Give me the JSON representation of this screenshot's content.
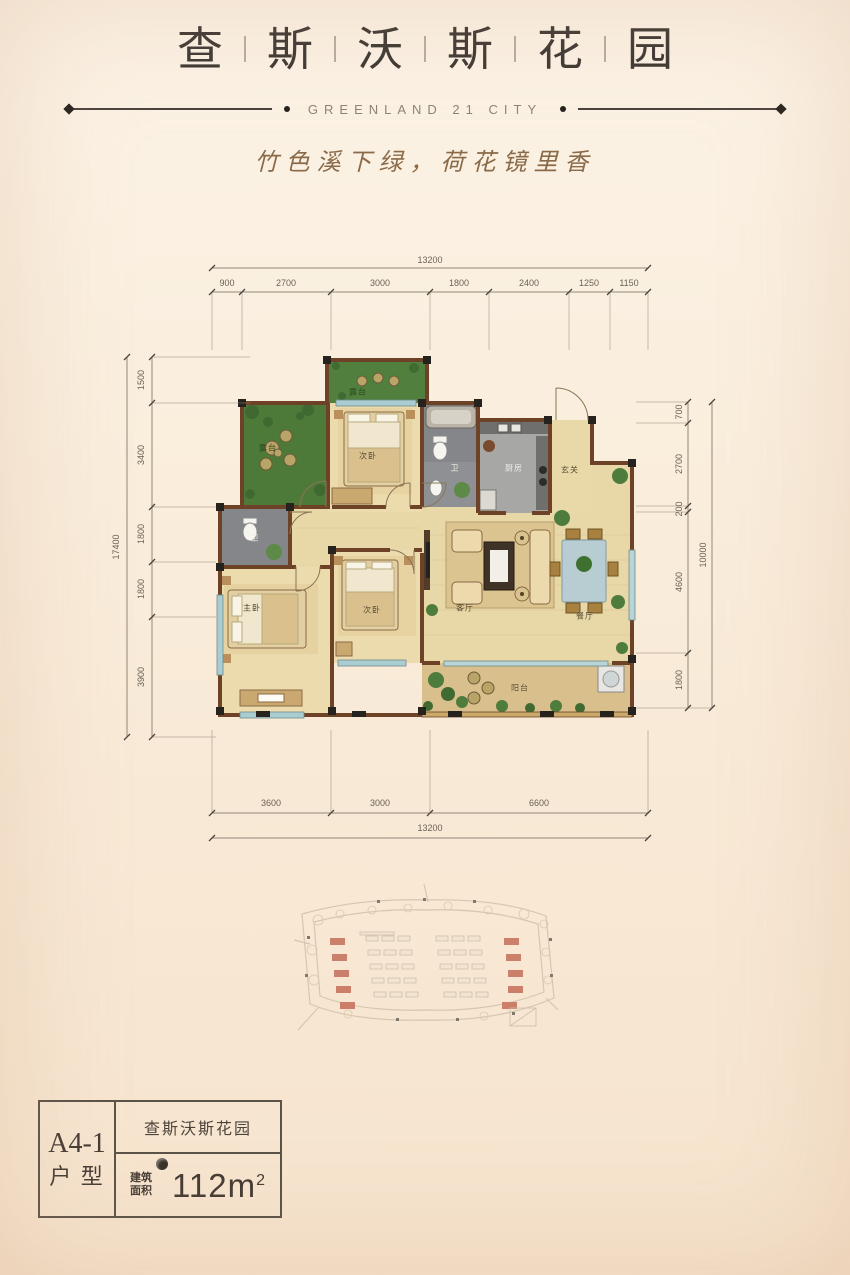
{
  "header": {
    "title_chars": [
      "查",
      "斯",
      "沃",
      "斯",
      "花",
      "园"
    ],
    "subtitle": "GREENLAND 21 CITY",
    "tagline": "竹色溪下绿，荷花镜里香"
  },
  "floorplan": {
    "rooms": {
      "terrace_top": "露台",
      "terrace_left": "露台",
      "bedroom2_top": "次卧",
      "bath1": "卫",
      "kitchen": "厨房",
      "entry": "玄关",
      "bath2": "卫",
      "master_bedroom": "主卧",
      "bedroom2_bottom": "次卧",
      "living_room": "客厅",
      "dining_room": "餐厅",
      "balcony": "阳台"
    },
    "dims_top": {
      "total": "13200",
      "segments": [
        "900",
        "2700",
        "3000",
        "1800",
        "2400",
        "1250",
        "1150"
      ]
    },
    "dims_bottom": {
      "total": "13200",
      "segments": [
        "3600",
        "3000",
        "6600"
      ]
    },
    "dims_left": {
      "total": "17400",
      "segments": [
        "1500",
        "3400",
        "1800",
        "1800",
        "3900"
      ]
    },
    "dims_right": {
      "total": "10000",
      "segments": [
        "700",
        "2700",
        "200",
        "4600",
        "1800"
      ]
    }
  },
  "info_box": {
    "unit_code": "A4-1",
    "unit_type_label": "户 型",
    "project_name": "查斯沃斯花园",
    "area_label_top": "建筑",
    "area_label_bottom": "面积",
    "area_value": "112m",
    "area_superscript": "2"
  },
  "colors": {
    "background_top": "#fcf3e6",
    "background_bottom": "#f6e3cd",
    "wall_brown": "#6e4226",
    "floor_tan": "#e8d7a7",
    "garden_green": "#4d7a39",
    "tile_gray": "#84868a",
    "highlight_red": "#b3402a",
    "tagline_brown": "#8a6a48"
  }
}
